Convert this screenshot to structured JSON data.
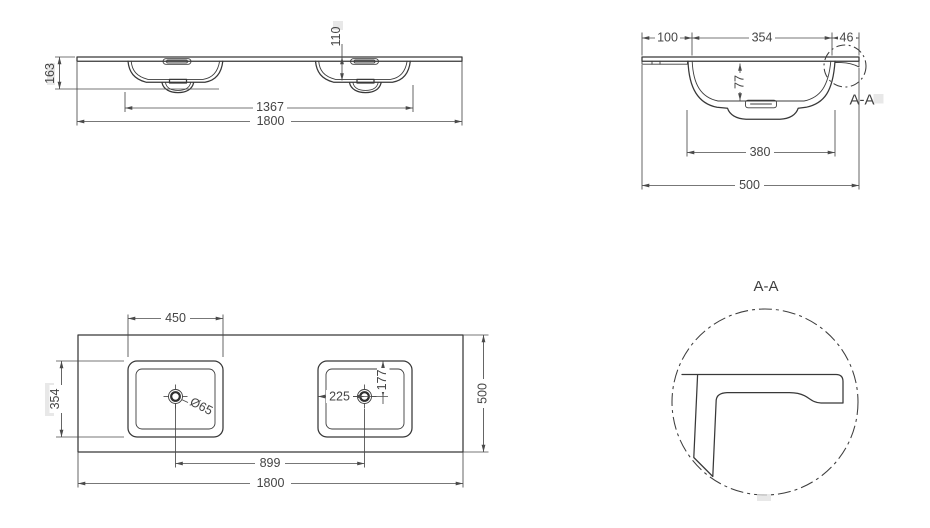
{
  "drawing_title": "double-basin-countertop-dimension-drawing",
  "colors": {
    "line": "#383838",
    "dimension_line": "#4a4a4a",
    "text": "#454545",
    "background": "#ffffff"
  },
  "front_view": {
    "height": "163",
    "bowl_depth": "110",
    "bowl_outer_span": "1367",
    "overall_width": "1800"
  },
  "section_view": {
    "rear_ledge": "100",
    "bowl_top_width": "354",
    "front_lip": "46",
    "bowl_depth": "77",
    "bowl_bottom_width": "380",
    "overall_depth": "500",
    "section_label": "A-A"
  },
  "plan_view": {
    "bowl_width": "450",
    "bowl_length": "354",
    "drain_diameter": "Ø65",
    "drain_inset": "225",
    "drain_offset": "177",
    "drain_spacing": "899",
    "overall_width": "1800",
    "overall_depth": "500"
  },
  "detail_view": {
    "title": "A-A"
  }
}
